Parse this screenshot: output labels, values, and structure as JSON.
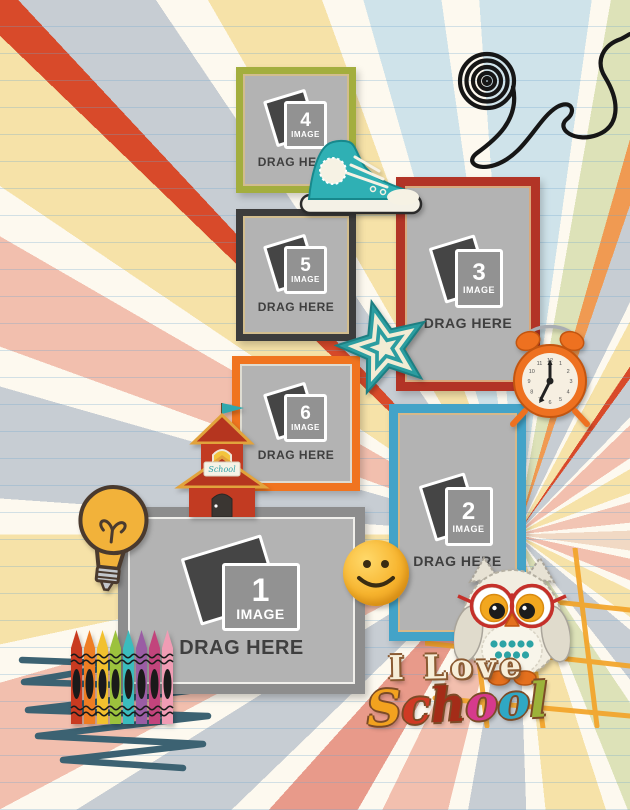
{
  "canvas": {
    "width": 630,
    "height": 810
  },
  "frames": [
    {
      "number": "1",
      "image_label": "IMAGE",
      "drag_label": "DRAG HERE",
      "border_color": "#8d8d8d"
    },
    {
      "number": "2",
      "image_label": "IMAGE",
      "drag_label": "DRAG HERE",
      "border_color": "#43a3c8"
    },
    {
      "number": "3",
      "image_label": "IMAGE",
      "drag_label": "DRAG HERE",
      "border_color": "#b23426"
    },
    {
      "number": "4",
      "image_label": "IMAGE",
      "drag_label": "DRAG HERE",
      "border_color": "#a3ae3e"
    },
    {
      "number": "5",
      "image_label": "IMAGE",
      "drag_label": "DRAG HERE",
      "border_color": "#3c3c3c"
    },
    {
      "number": "6",
      "image_label": "IMAGE",
      "drag_label": "DRAG HERE",
      "border_color": "#f0741f"
    }
  ],
  "title": {
    "line1": "I Love",
    "school_letters": [
      {
        "char": "S",
        "color": "#f2a21f"
      },
      {
        "char": "c",
        "color": "#cf3a24"
      },
      {
        "char": "h",
        "color": "#a42c18"
      },
      {
        "char": "o",
        "color": "#d63a8c"
      },
      {
        "char": "o",
        "color": "#2fa8c4"
      },
      {
        "char": "l",
        "color": "#9cb23a"
      }
    ]
  },
  "clock": {
    "numerals": [
      "12",
      "1",
      "2",
      "3",
      "4",
      "5",
      "6",
      "7",
      "8",
      "9",
      "10",
      "11"
    ]
  },
  "decorations": {
    "schoolhouse_sign": "School",
    "icons": [
      "wire-scribble-icon",
      "sneaker-icon",
      "star-icon",
      "alarm-clock-icon",
      "schoolhouse-icon",
      "lightbulb-icon",
      "smiley-icon",
      "owl-icon",
      "crayons-icon",
      "squiggle-icon",
      "grid-doodle-icon"
    ]
  },
  "palette": {
    "paper": "#f8f3e6",
    "ray_gray": "#c7cdd3",
    "ray_salmon": "#f2bfae",
    "ray_yellow": "#f6e2a8",
    "placeholder_gray": "#b3b3b3",
    "sneaker_teal": "#2fb0b4",
    "clock_orange": "#ee7120",
    "scribble_slate": "#3c6272",
    "grid_orange": "#f3a428"
  }
}
